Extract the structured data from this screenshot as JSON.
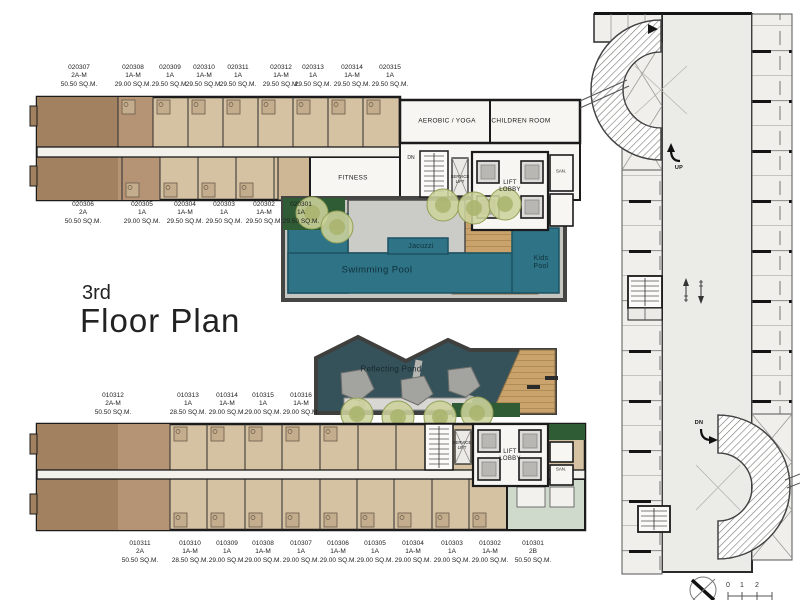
{
  "title": {
    "floor": "3rd",
    "name": "Floor Plan"
  },
  "units": {
    "tw_u": [
      {
        "no": "020307",
        "type": "2A-M",
        "area": "50.50 SQ.M."
      },
      {
        "no": "020308",
        "type": "1A-M",
        "area": "29.00 SQ.M."
      },
      {
        "no": "020309",
        "type": "1A",
        "area": "29.50 SQ.M."
      },
      {
        "no": "020310",
        "type": "1A-M",
        "area": "29.50 SQ.M."
      },
      {
        "no": "020311",
        "type": "1A",
        "area": "29.50 SQ.M."
      },
      {
        "no": "020312",
        "type": "1A-M",
        "area": "29.50 SQ.M."
      },
      {
        "no": "020313",
        "type": "1A",
        "area": "29.50 SQ.M."
      },
      {
        "no": "020314",
        "type": "1A-M",
        "area": "29.50 SQ.M."
      },
      {
        "no": "020315",
        "type": "1A",
        "area": "29.50 SQ.M."
      }
    ],
    "tw_l": [
      {
        "no": "020306",
        "type": "2A",
        "area": "50.50 SQ.M."
      },
      {
        "no": "020305",
        "type": "1A",
        "area": "29.00 SQ.M."
      },
      {
        "no": "020304",
        "type": "1A-M",
        "area": "29.50 SQ.M."
      },
      {
        "no": "020303",
        "type": "1A",
        "area": "29.50 SQ.M."
      },
      {
        "no": "020302",
        "type": "1A-M",
        "area": "29.50 SQ.M."
      },
      {
        "no": "020301",
        "type": "1A",
        "area": "29.50 SQ.M."
      }
    ],
    "bw_u": [
      {
        "no": "010312",
        "type": "2A-M",
        "area": "50.50 SQ.M."
      },
      {
        "no": "010313",
        "type": "1A",
        "area": "28.50 SQ.M."
      },
      {
        "no": "010314",
        "type": "1A-M",
        "area": "29.00 SQ.M."
      },
      {
        "no": "010315",
        "type": "1A",
        "area": "29.00 SQ.M."
      },
      {
        "no": "010316",
        "type": "1A-M",
        "area": "29.00 SQ.M."
      }
    ],
    "bw_l": [
      {
        "no": "010311",
        "type": "2A",
        "area": "50.50 SQ.M."
      },
      {
        "no": "010310",
        "type": "1A-M",
        "area": "28.50 SQ.M."
      },
      {
        "no": "010309",
        "type": "1A",
        "area": "29.00 SQ.M."
      },
      {
        "no": "010308",
        "type": "1A-M",
        "area": "29.00 SQ.M."
      },
      {
        "no": "010307",
        "type": "1A",
        "area": "29.00 SQ.M."
      },
      {
        "no": "010306",
        "type": "1A-M",
        "area": "29.00 SQ.M."
      },
      {
        "no": "010305",
        "type": "1A",
        "area": "29.00 SQ.M."
      },
      {
        "no": "010304",
        "type": "1A-M",
        "area": "29.00 SQ.M."
      },
      {
        "no": "010303",
        "type": "1A",
        "area": "29.00 SQ.M."
      },
      {
        "no": "010302",
        "type": "1A-M",
        "area": "29.00 SQ.M."
      },
      {
        "no": "010301",
        "type": "2B",
        "area": "50.50 SQ.M."
      }
    ]
  },
  "rooms": {
    "aerobic": "AEROBIC / YOGA",
    "children": "CHILDREN ROOM",
    "fitness": "FITNESS",
    "lift1": "LIFT",
    "lift2": "LOBBY",
    "service1": "SERVICE",
    "service2": "LIFT",
    "san": "SAN.",
    "dn": "DN",
    "up": "UP"
  },
  "pool": {
    "jacuzzi": "Jacuzzi",
    "swimming": "Swimming Pool",
    "kids1": "Kids",
    "kids2": "Pool"
  },
  "pond": {
    "label": "Reflecting Pond"
  },
  "scale": {
    "m0": "0",
    "m1": "1",
    "m2": "2"
  },
  "colors": {
    "unit_tan": "#d5c2a2",
    "unit_brown": "#a28161",
    "unit_mid": "#b59475",
    "pool_teal": "#2e7386",
    "pond_teal": "#35525b",
    "wood": "#c9a36b",
    "hedge": "#305c35",
    "walkway": "#c5c5c1",
    "garage": "#ebebe7"
  }
}
